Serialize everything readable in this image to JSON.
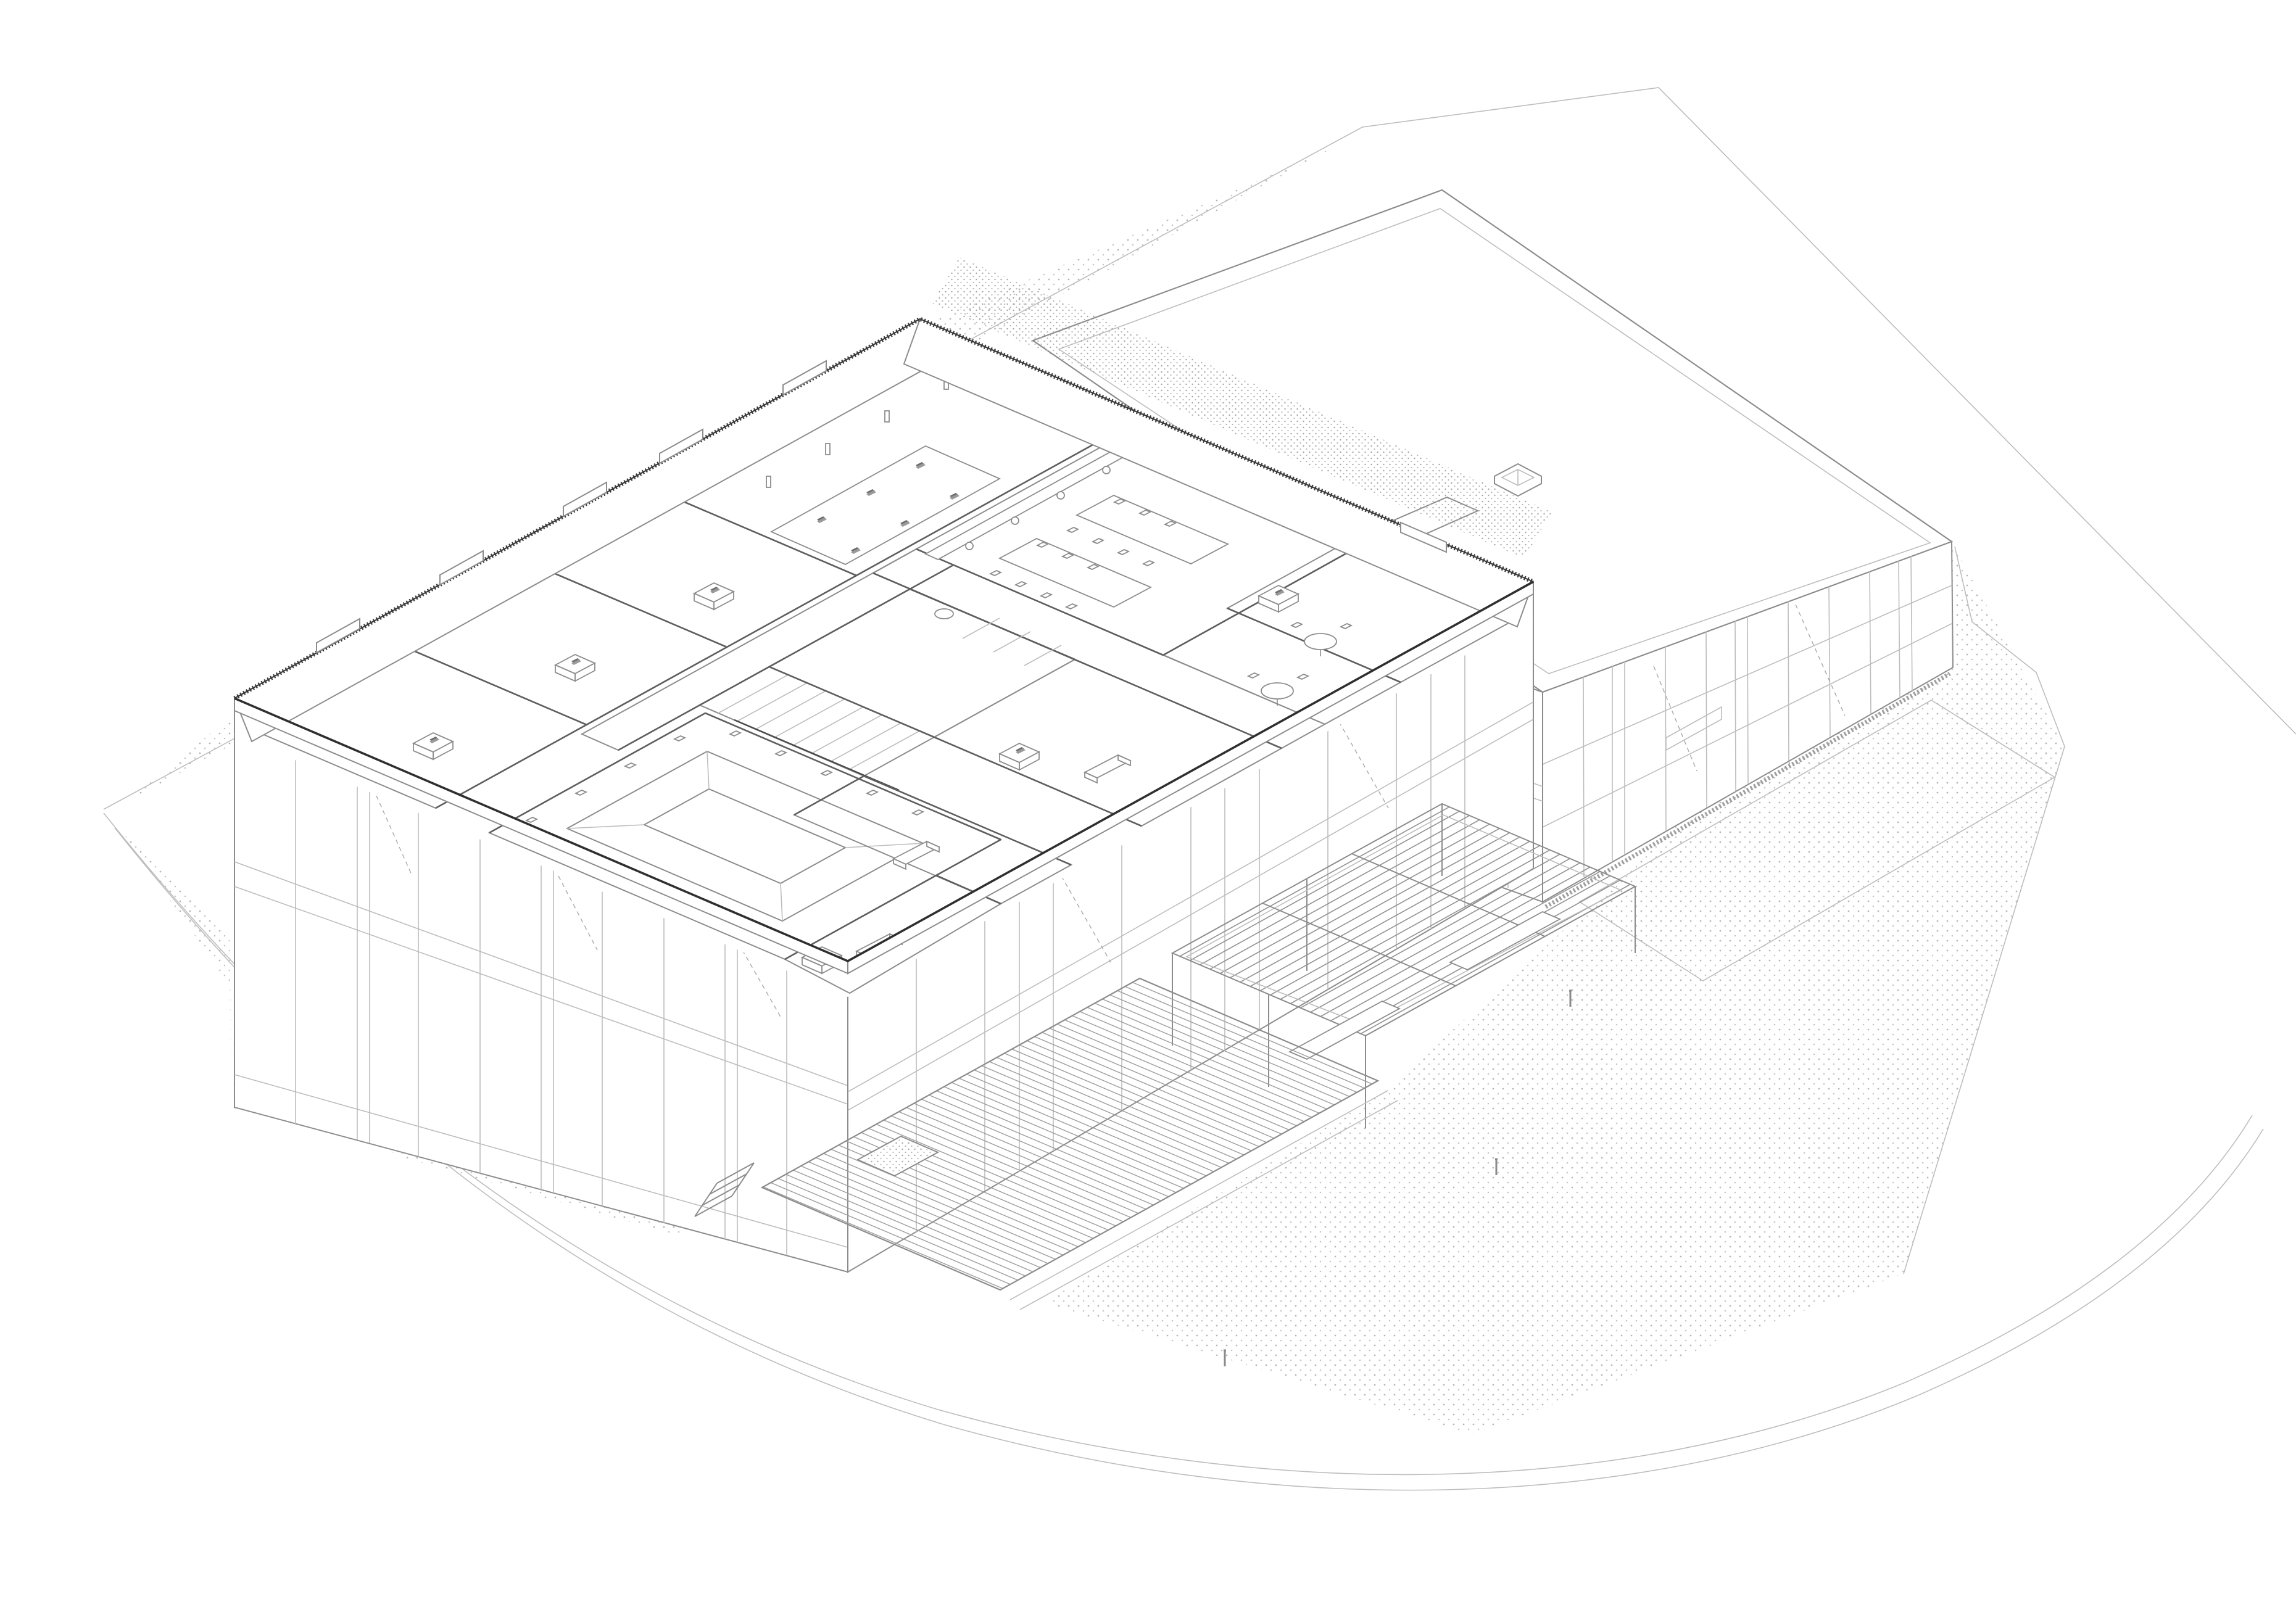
{
  "document": {
    "kind": "architectural axonometric cutaway drawing",
    "projection": "trimetric bird's-eye",
    "visible_text": "none",
    "paper_color": "#ffffff"
  },
  "palette": {
    "paper": "#ffffff",
    "line": "#8c8c8c",
    "line_light": "#bdbdbd",
    "line_dark": "#2f2f2f",
    "wall_mid": "#5e5e5e",
    "zone_blue": "#dce7f3",
    "zone_green": "#e3efdc",
    "zone_pink": "#f8dada",
    "stipple": "#b5b5b5",
    "furniture_line": "#8c8c8c",
    "laptop_dark": "#6d6d6d"
  },
  "site": {
    "boundary": "irregular polygon, thin light line, exits top-right",
    "road": "curved double line sweeping along the south edge",
    "ground_textures": [
      "stippled lawn north-west of left wing",
      "stippled gravel east and south of hall",
      "dense stipple strip between the two volumes"
    ]
  },
  "left_wing": {
    "form": "two-storey bar with gridded facade, upper floor cut open to reveal plan",
    "parapet": "hatched coping band with clerestory window stubs",
    "rooms": [
      {
        "name": "office-1",
        "zone": "zone_blue",
        "furniture": [
          "desk",
          "laptop"
        ]
      },
      {
        "name": "office-2",
        "zone": "zone_blue",
        "furniture": [
          "desk",
          "laptop"
        ]
      },
      {
        "name": "office-3",
        "zone": "zone_blue",
        "furniture": [
          "desk",
          "laptop"
        ]
      },
      {
        "name": "open-office",
        "zone": "zone_blue",
        "furniture": [
          "long table",
          "6 laptops",
          "window counter"
        ]
      },
      {
        "name": "corridor-main",
        "zone": "zone_green"
      },
      {
        "name": "corridor-leg",
        "zone": "zone_green"
      },
      {
        "name": "wc-core",
        "zone": "white",
        "furniture": [
          "sink",
          "stall partitions"
        ]
      },
      {
        "name": "stair",
        "zone": "white",
        "furniture": [
          "steps",
          "railing"
        ]
      },
      {
        "name": "dining-hall",
        "zone": "zone_pink",
        "furniture": [
          "2 long tables",
          "16 chairs",
          "kitchen counter",
          "4 stools"
        ]
      },
      {
        "name": "auditorium-pit",
        "zone": "zone_pink",
        "furniture": [
          "sunken pit",
          "perimeter chairs"
        ]
      },
      {
        "name": "meeting-room",
        "zone": "zone_green",
        "furniture": [
          "round table",
          "chairs",
          "desk"
        ]
      },
      {
        "name": "lounge-round-table",
        "zone": "zone_blue",
        "furniture": [
          "round table",
          "chairs"
        ]
      },
      {
        "name": "office-couch-e",
        "zone": "zone_blue",
        "furniture": [
          "couch",
          "desk"
        ]
      },
      {
        "name": "office-couch-s",
        "zone": "zone_blue",
        "furniture": [
          "couch"
        ]
      },
      {
        "name": "office-corner-s",
        "zone": "zone_blue",
        "furniture": [
          "couch",
          "desk"
        ]
      }
    ]
  },
  "hall": {
    "form": "taller volume with blank flat roof, double parapet line",
    "skylight": "small square pyramidal skylight near roof centre",
    "facades": "curtain-wall grid of mullions and transoms, rubble drainage strip at base"
  },
  "outdoor_structures": [
    {
      "name": "pergola",
      "form": "open lattice canopy of parallel slats on slender posts",
      "extras": [
        "benches beneath"
      ]
    },
    {
      "name": "timber-deck",
      "form": "large slatted deck with square planter opening and side ramp"
    },
    {
      "name": "entry-steps",
      "form": "small concrete flight at deck west corner"
    },
    {
      "name": "bollards",
      "count": 3
    }
  ]
}
